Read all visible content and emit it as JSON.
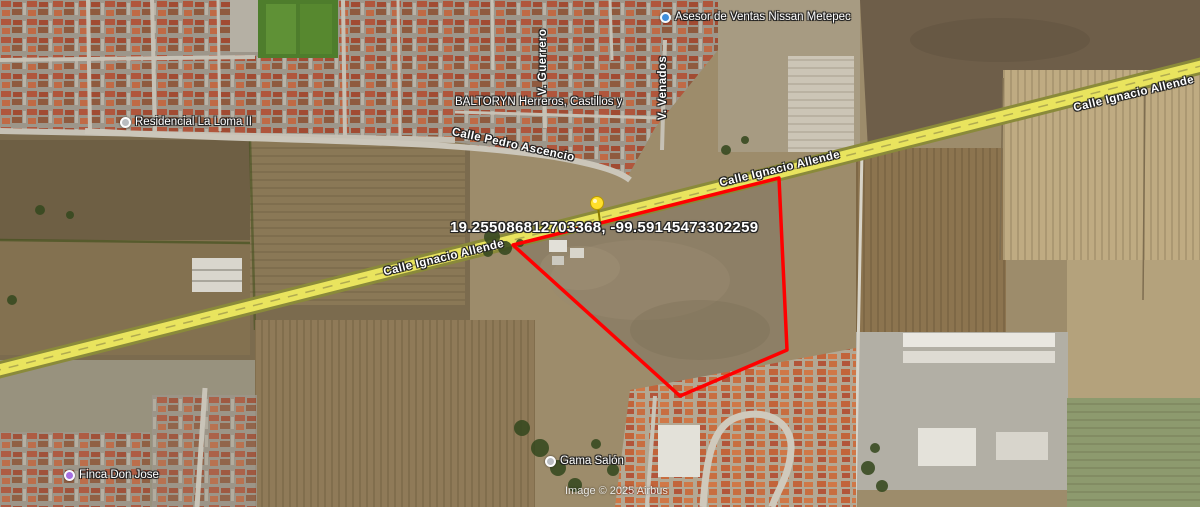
{
  "map": {
    "coordinates_label": "19.255086812703368, -99.59145473302259",
    "watermark": "Image © 2025 Airbus",
    "colors": {
      "property_boundary": "#ff0000",
      "highway": "#e9e45e",
      "pushpin": "#ffdf2b"
    }
  },
  "streets": {
    "ignacio_allende": "Calle Ignacio Allende",
    "pedro_ascencio": "Calle Pedro Ascencio",
    "v_guerrero": "V. Guerrero",
    "v_venados": "V. Venados"
  },
  "places": {
    "nissan": {
      "name": "Asesor de Ventas Nissan Metepec",
      "icon": "blue-place-dot"
    },
    "residencial": {
      "name": "Residencial La Loma II",
      "icon": "grey-place-dot"
    },
    "baltoryn": {
      "name": "BALTORYN Herreros, Castillos y",
      "icon": "none"
    },
    "gama": {
      "name": "Gama Salón",
      "icon": "grey-place-dot"
    },
    "finca": {
      "name": "Finca Don Jose",
      "icon": "purple-place-dot"
    }
  }
}
